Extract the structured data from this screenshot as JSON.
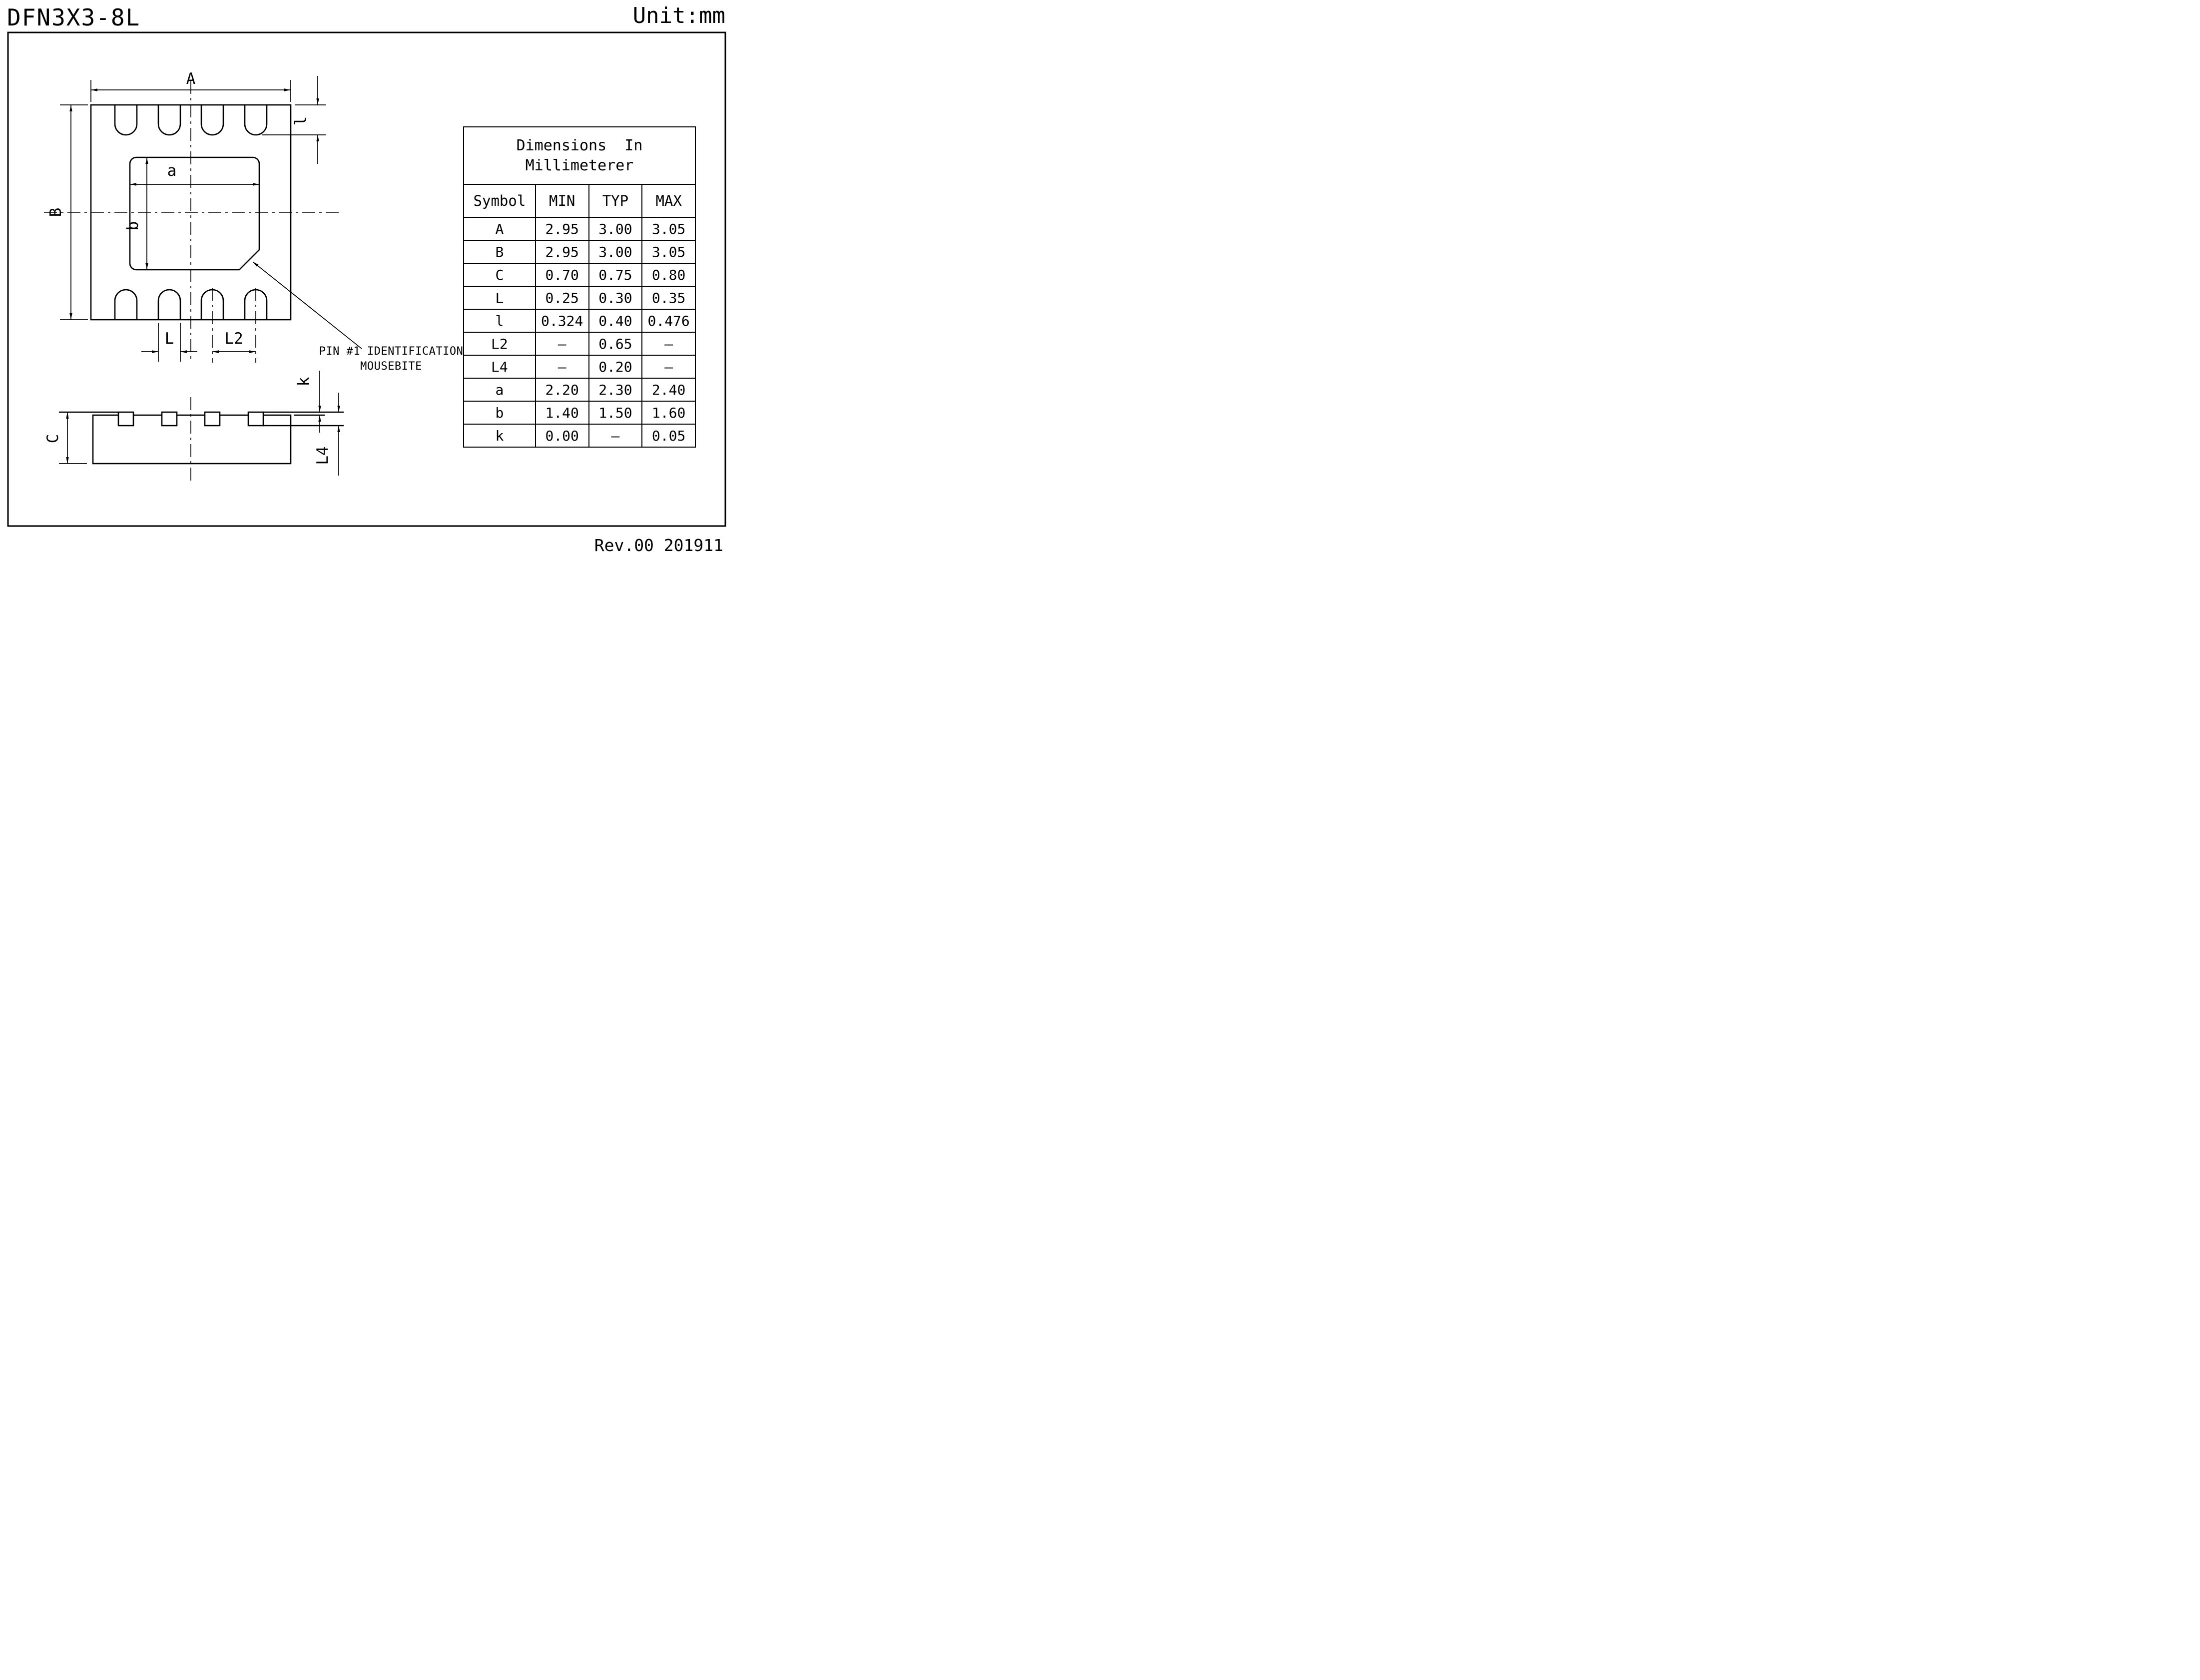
{
  "sheet": {
    "title": "DFN3X3-8L",
    "unit": "Unit:mm",
    "revision": "Rev.00 201911"
  },
  "top_view": {
    "overall_width_label": "A",
    "overall_height_label": "B",
    "epad_width_label": "a",
    "epad_height_label": "b",
    "lead_length_label": "l",
    "lead_width_label": "L",
    "lead_pitch_label": "L2",
    "pin1_note_line1": "PIN #1 IDENTIFICATION",
    "pin1_note_line2": "MOUSEBITE"
  },
  "side_view": {
    "thickness_label": "C",
    "standoff_label": "k",
    "terminal_label": "L4"
  },
  "table": {
    "title_line1": "Dimensions  In",
    "title_line2": "Millimeterer",
    "headers": [
      "Symbol",
      "MIN",
      "TYP",
      "MAX"
    ],
    "rows": [
      {
        "symbol": "A",
        "min": "2.95",
        "typ": "3.00",
        "max": "3.05"
      },
      {
        "symbol": "B",
        "min": "2.95",
        "typ": "3.00",
        "max": "3.05"
      },
      {
        "symbol": "C",
        "min": "0.70",
        "typ": "0.75",
        "max": "0.80"
      },
      {
        "symbol": "L",
        "min": "0.25",
        "typ": "0.30",
        "max": "0.35"
      },
      {
        "symbol": "l",
        "min": "0.324",
        "typ": "0.40",
        "max": "0.476"
      },
      {
        "symbol": "L2",
        "min": "–",
        "typ": "0.65",
        "max": "–"
      },
      {
        "symbol": "L4",
        "min": "–",
        "typ": "0.20",
        "max": "–"
      },
      {
        "symbol": "a",
        "min": "2.20",
        "typ": "2.30",
        "max": "2.40"
      },
      {
        "symbol": "b",
        "min": "1.40",
        "typ": "1.50",
        "max": "1.60"
      },
      {
        "symbol": "k",
        "min": "0.00",
        "typ": "–",
        "max": "0.05"
      }
    ]
  },
  "colors": {
    "line": "#000000",
    "background": "#ffffff"
  }
}
